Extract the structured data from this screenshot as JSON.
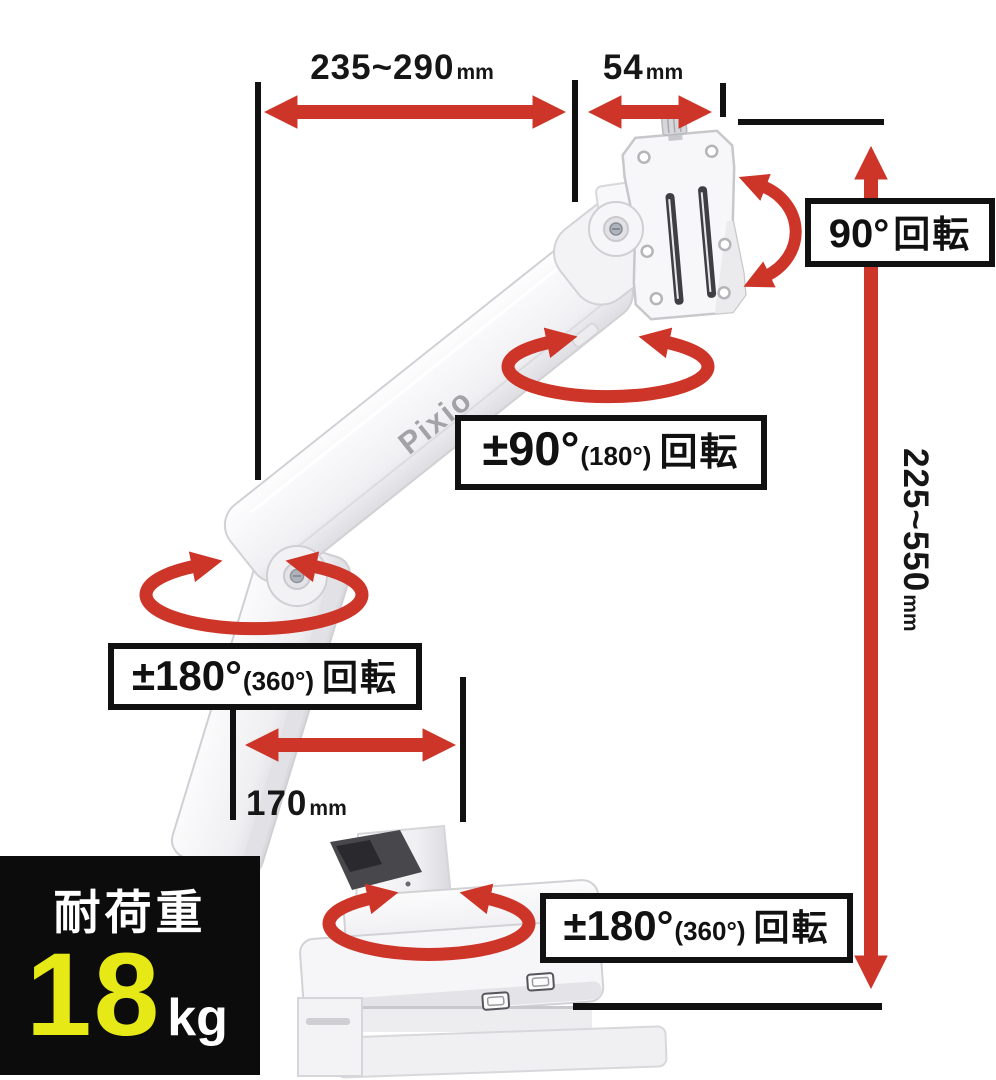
{
  "brand": {
    "logo_text": "Pixio"
  },
  "measurements": {
    "arm_horizontal_reach": {
      "value": "235~290",
      "unit": "mm"
    },
    "vesa_plate_depth": {
      "value": "54",
      "unit": "mm"
    },
    "height_adjust_range": {
      "value": "225~550",
      "unit": "mm"
    },
    "lower_arm_length": {
      "value": "170",
      "unit": "mm"
    }
  },
  "rotation_labels": {
    "vesa_rotation": {
      "main": "90°",
      "suffix": "回転"
    },
    "upper_joint": {
      "main": "±90°",
      "paren": "(180°)",
      "suffix": "回転"
    },
    "elbow_joint": {
      "main": "±180°",
      "paren": "(360°)",
      "suffix": "回転"
    },
    "base_joint": {
      "main": "±180°",
      "paren": "(360°)",
      "suffix": "回転"
    }
  },
  "load_capacity": {
    "label": "耐荷重",
    "value": "18",
    "unit": "kg"
  },
  "colors": {
    "accent_red": "#ce3529",
    "highlight_yellow": "#e6e915",
    "panel_black": "#0c0c0c"
  }
}
